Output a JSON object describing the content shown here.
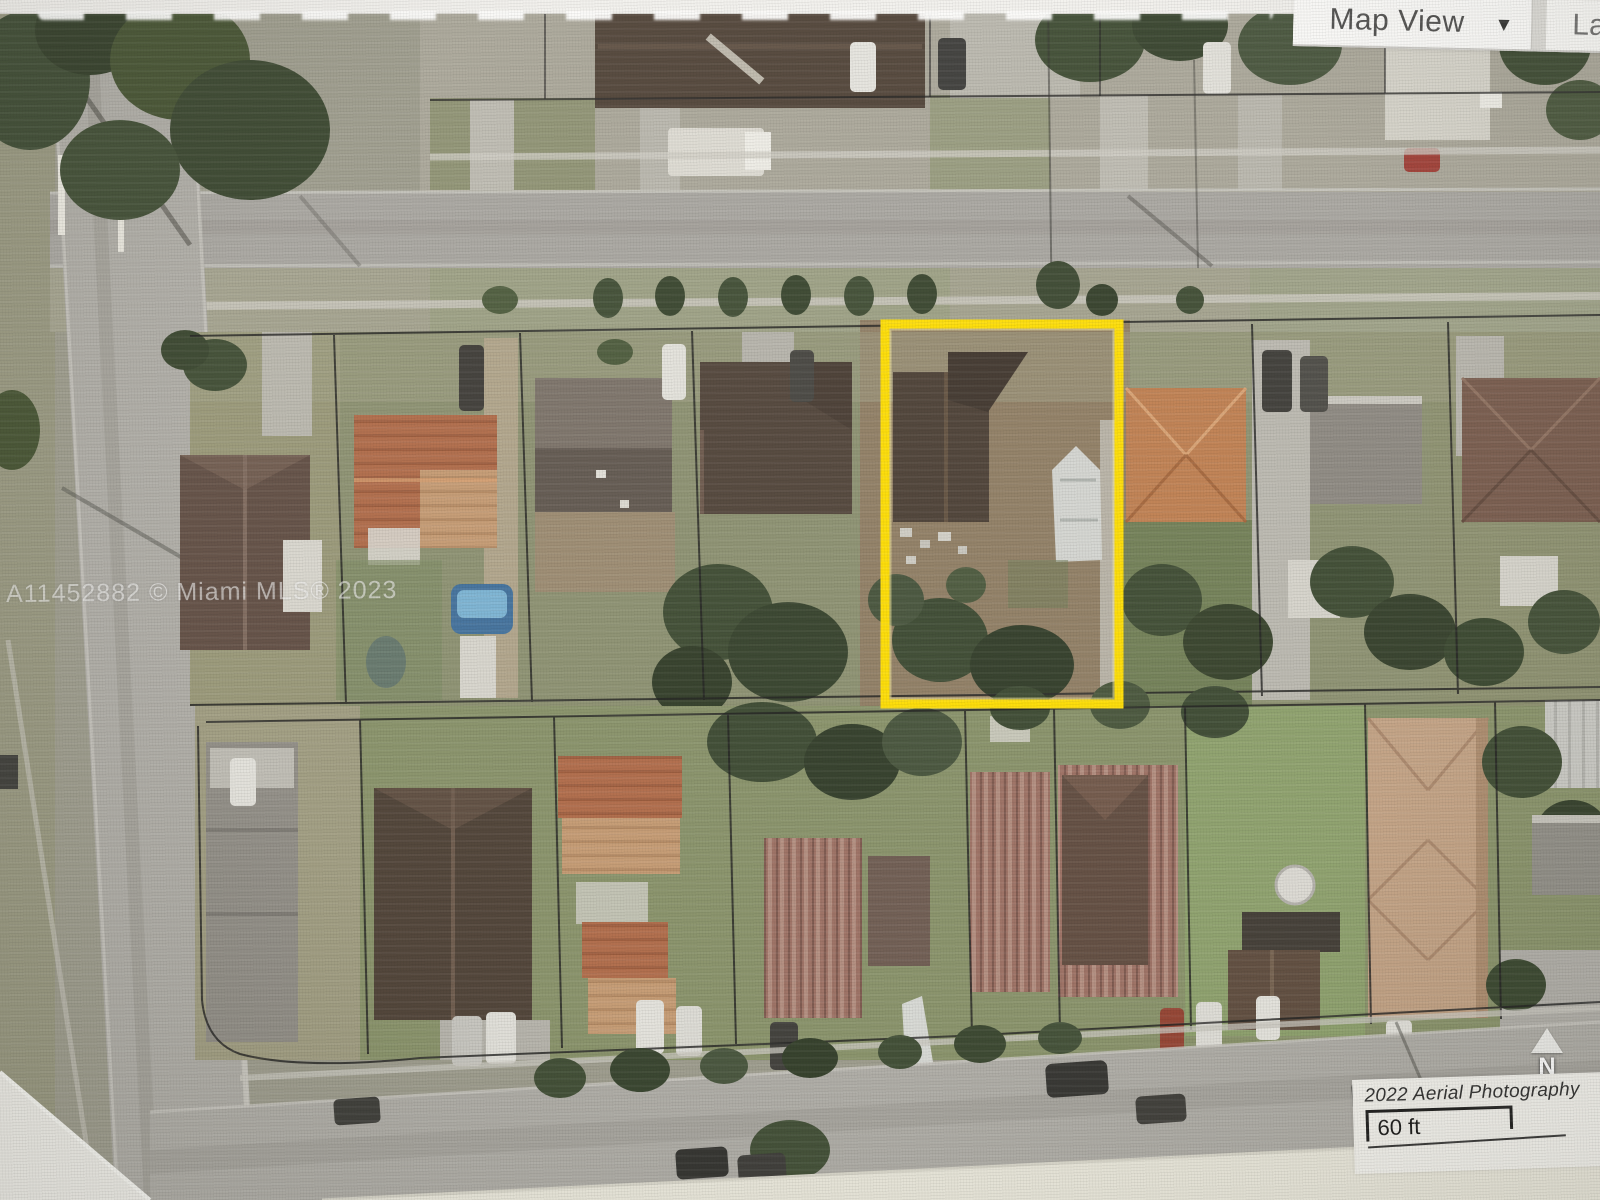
{
  "toolbar": {
    "map_view_label": "Map View",
    "dropdown_glyph": "▼",
    "right_partial_label": "La"
  },
  "watermark": {
    "text": "A11452882 © Miami MLS® 2023"
  },
  "scale_panel": {
    "title": "2022 Aerial Photography",
    "scale_label": "60 ft"
  },
  "compass": {
    "north_label": "N"
  },
  "highlight": {
    "outline_color": "#FFDE00"
  }
}
